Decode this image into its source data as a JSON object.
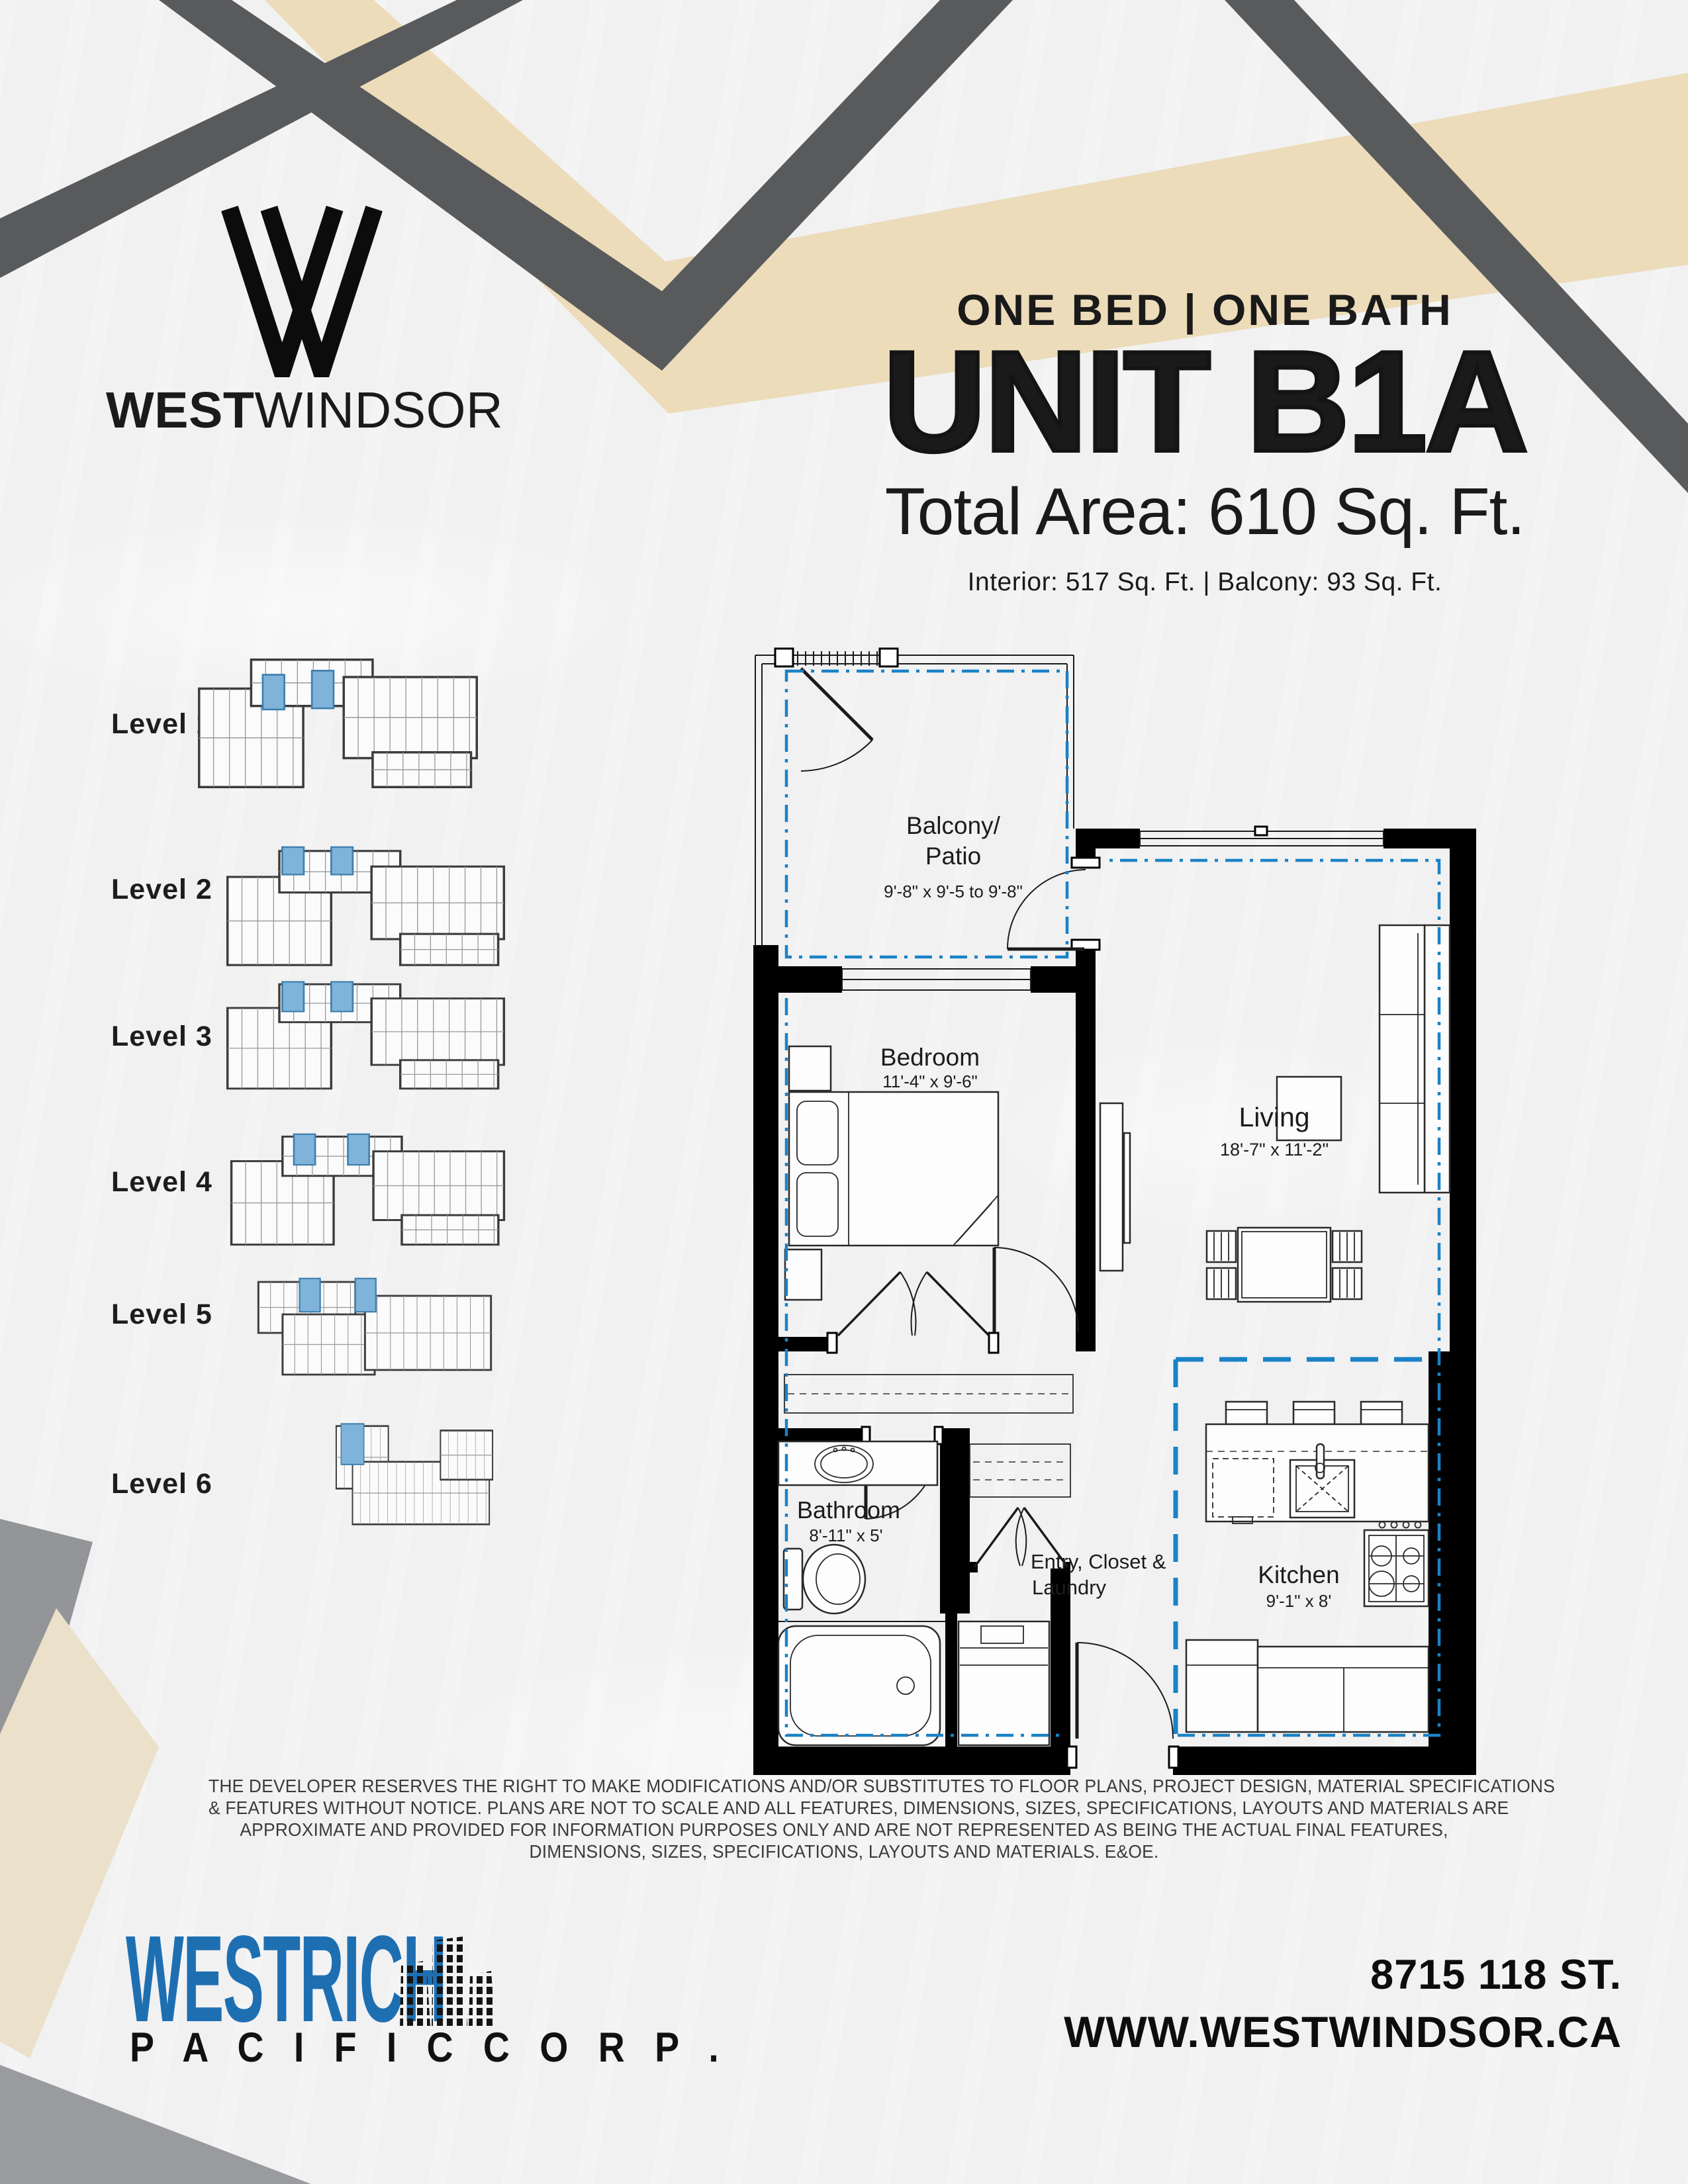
{
  "brand": {
    "logo_bold": "WEST",
    "logo_light": "WINDSOR",
    "w_mark_icon": "w-monogram-icon"
  },
  "header": {
    "subtitle": "ONE BED | ONE BATH",
    "title": "UNIT B1A",
    "total_area": "Total Area: 610 Sq. Ft.",
    "breakdown": "Interior: 517 Sq. Ft. | Balcony: 93 Sq. Ft."
  },
  "levels": [
    {
      "label": "Level 1"
    },
    {
      "label": "Level 2"
    },
    {
      "label": "Level 3"
    },
    {
      "label": "Level 4"
    },
    {
      "label": "Level 5"
    },
    {
      "label": "Level 6"
    }
  ],
  "floorplan": {
    "boundary_color": "#1a82c6",
    "highlight_color": "#7fb3d9",
    "rooms": [
      {
        "name": "Balcony/",
        "name2": "Patio",
        "dim": "9'-8\" x 9'-5 to 9'-8\""
      },
      {
        "name": "Bedroom",
        "dim": "11'-4\" x 9'-6\""
      },
      {
        "name": "Living",
        "dim": "18'-7\" x 11'-2\""
      },
      {
        "name": "Bathroom",
        "dim": "8'-11\" x 5'"
      },
      {
        "name": "Entry, Closet &",
        "name2": "Laundry"
      },
      {
        "name": "Kitchen",
        "dim": "9'-1\" x 8'"
      }
    ]
  },
  "disclaimer": {
    "lines": [
      "THE DEVELOPER RESERVES THE RIGHT TO MAKE MODIFICATIONS AND/OR SUBSTITUTES TO FLOOR PLANS, PROJECT DESIGN, MATERIAL SPECIFICATIONS",
      "& FEATURES WITHOUT NOTICE. PLANS ARE NOT TO SCALE AND ALL FEATURES, DIMENSIONS, SIZES, SPECIFICATIONS, LAYOUTS AND MATERIALS ARE",
      "APPROXIMATE AND PROVIDED FOR INFORMATION PURPOSES ONLY AND ARE NOT REPRESENTED AS BEING THE ACTUAL FINAL FEATURES,",
      "DIMENSIONS, SIZES, SPECIFICATIONS, LAYOUTS AND MATERIALS. E&OE."
    ]
  },
  "footer": {
    "developer": "WESTRICH",
    "developer_sub": "P A C I F I C   C O R P .",
    "towers_icon": "building-towers-icon",
    "address": "8715 118 ST.",
    "website": "WWW.WESTWINDSOR.CA"
  },
  "colors": {
    "ribbon_gray_dark": "#595a5c",
    "ribbon_gray_light": "#939598",
    "ribbon_beige_top": "#ecdcba",
    "ribbon_beige_bottom": "#ebe0c9",
    "westrich_blue": "#1e6fb2",
    "plan_blue": "#1a82c6"
  }
}
